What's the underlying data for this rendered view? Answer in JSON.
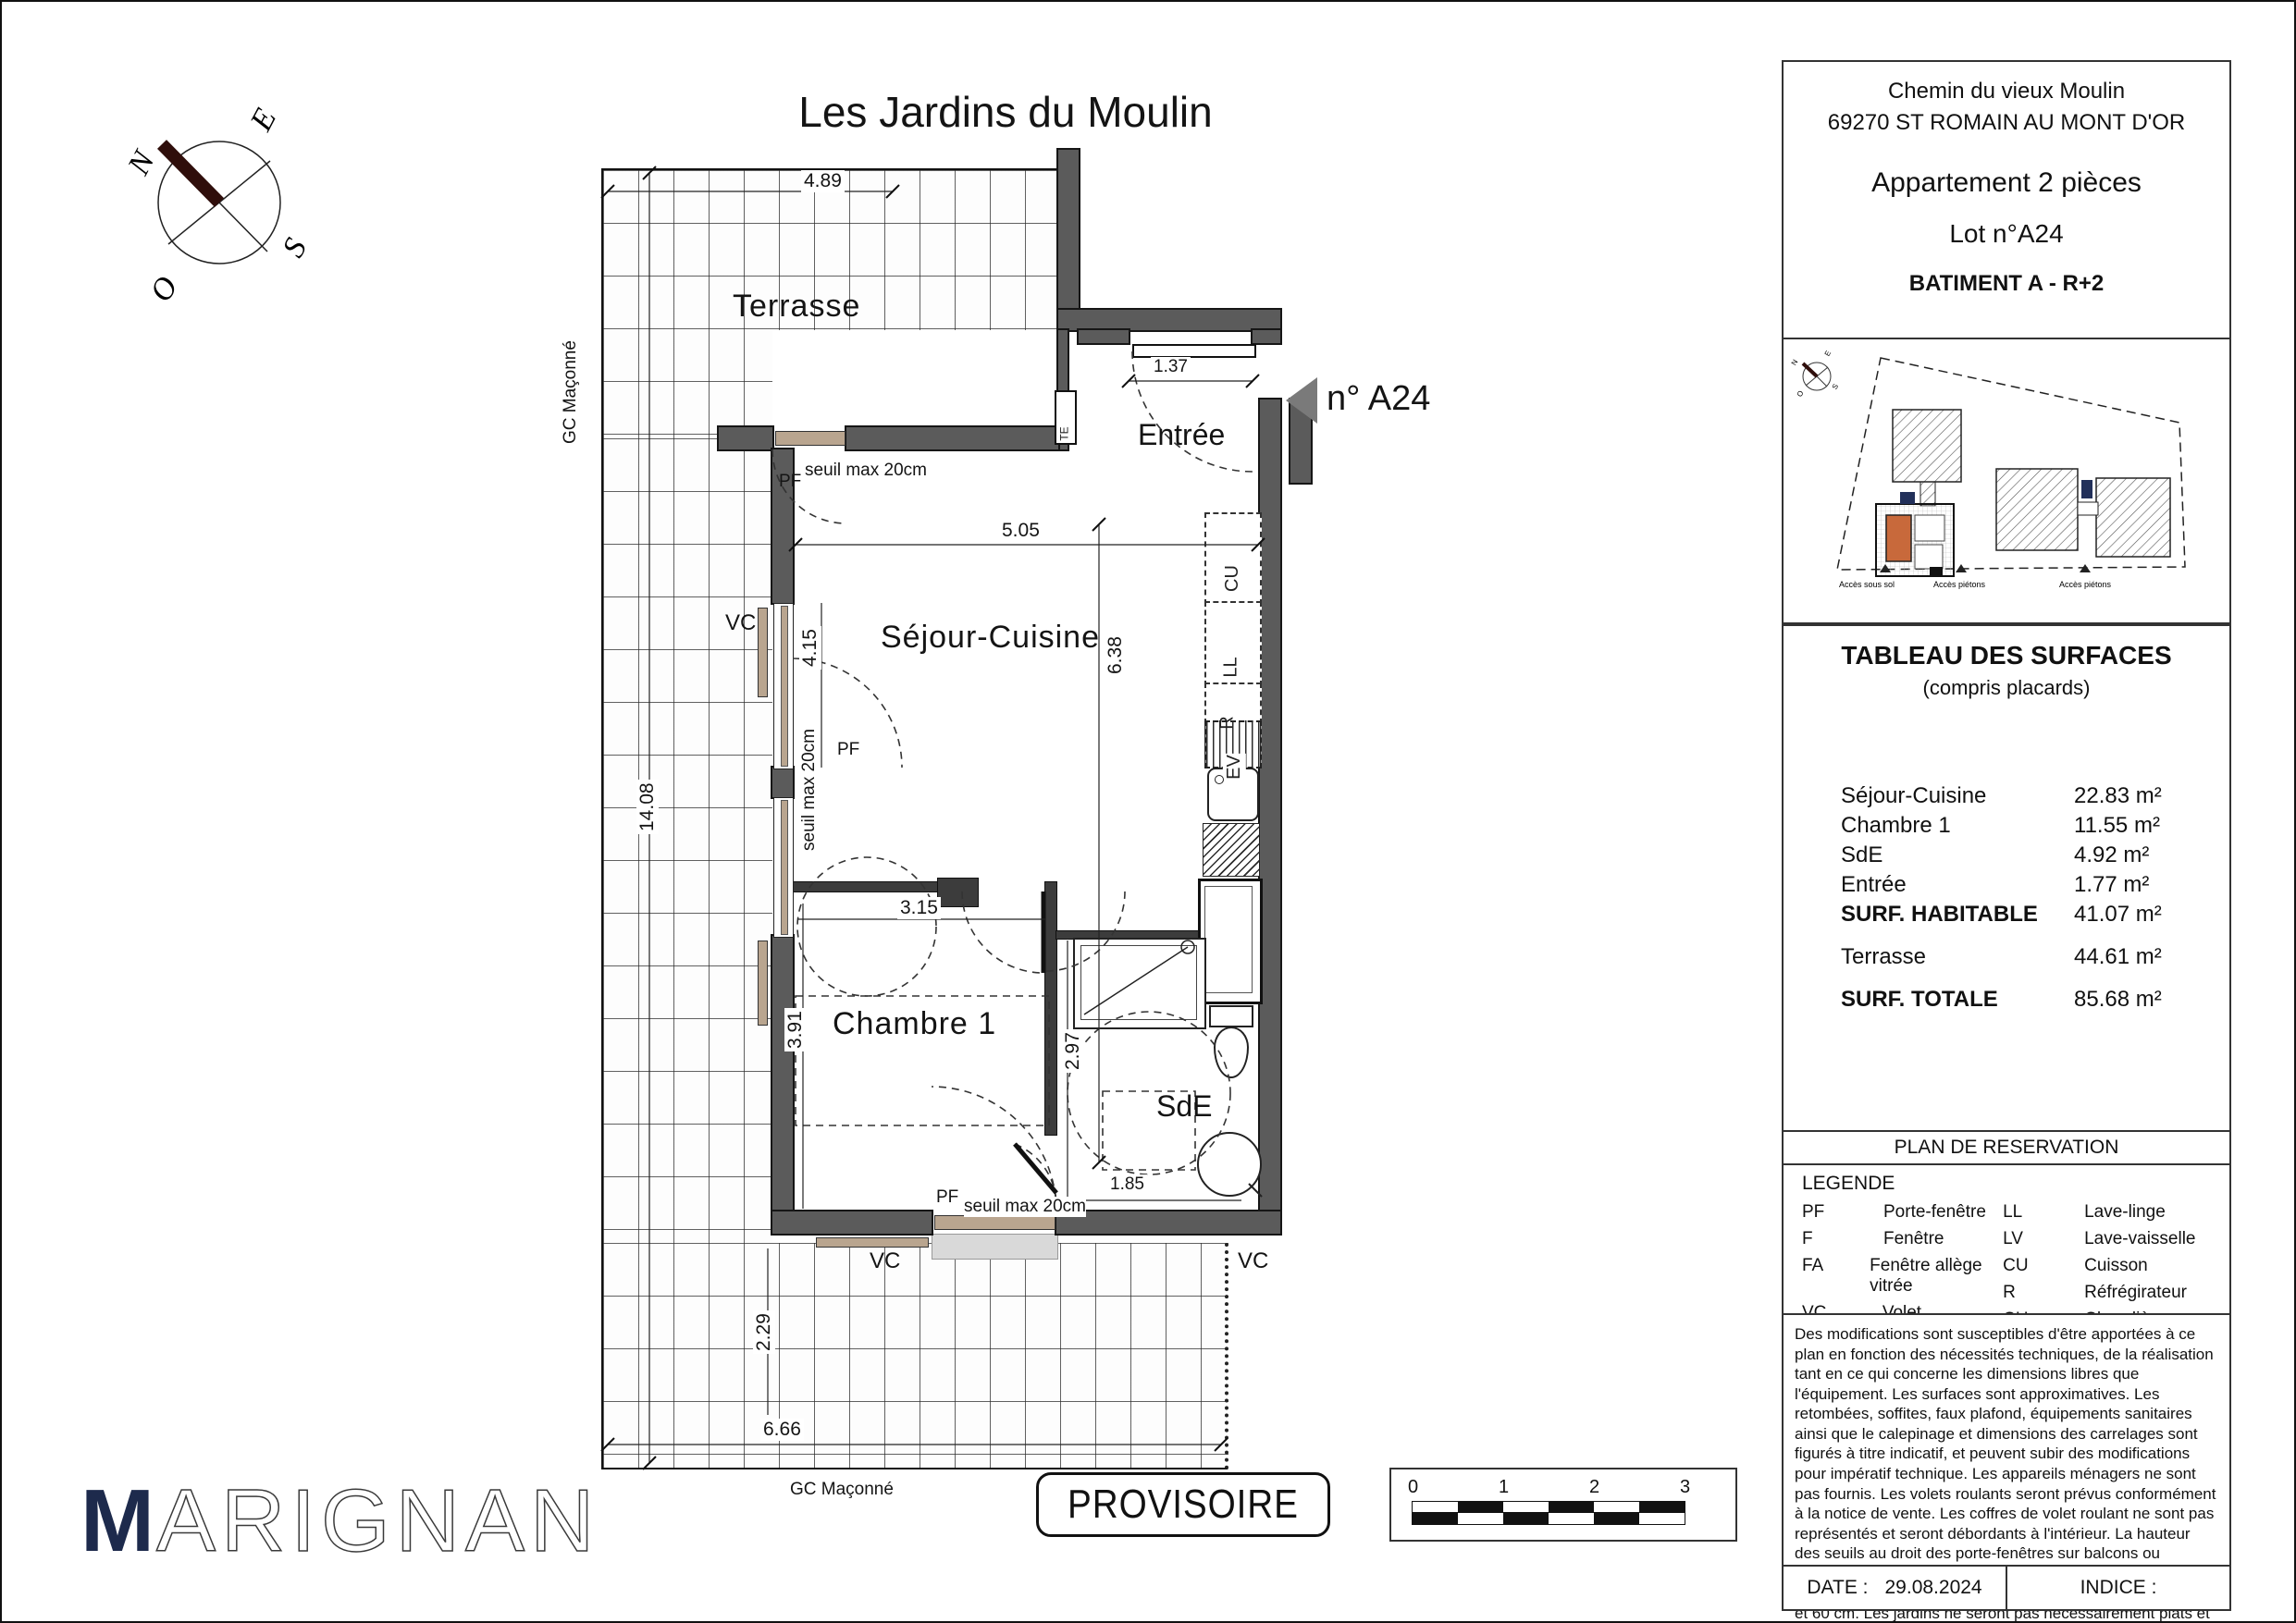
{
  "title": "Les Jardins du Moulin",
  "stamp": "PROVISOIRE",
  "logo": {
    "first": "M",
    "rest": "ARIGNAN"
  },
  "compass": {
    "n": "N",
    "e": "E",
    "s": "S",
    "o": "O"
  },
  "plan": {
    "rooms": {
      "terrasse": "Terrasse",
      "entree": "Entrée",
      "sejour": "Séjour-Cuisine",
      "chambre": "Chambre 1",
      "sde": "SdE"
    },
    "unit_arrow_label": "n° A24",
    "dims": {
      "terrace_top": "4.89",
      "terrace_left": "14.08",
      "entry_door": "1.37",
      "sejour_w": "5.05",
      "sejour_left": "4.15",
      "sejour_h": "6.38",
      "chambre_w": "3.15",
      "chambre_h": "3.91",
      "sde_h": "2.97",
      "sde_w": "1.85",
      "terrace_bot_h": "2.29",
      "terrace_bot_w": "6.66"
    },
    "annotations": {
      "seuil": "seuil max 20cm",
      "pf": "PF",
      "vc": "VC",
      "gc": "GC Maçonné",
      "te": "TE",
      "cu": "CU",
      "ll": "LL",
      "r": "R",
      "ev": "EV"
    }
  },
  "info_panel": {
    "address1": "Chemin du vieux Moulin",
    "address2": "69270 ST ROMAIN AU MONT D'OR",
    "type": "Appartement 2 pièces",
    "lot": "Lot n°A24",
    "building": "BATIMENT A -  R+2"
  },
  "site_plan": {
    "access1": "Accès sous sol",
    "access2": "Accès piétons",
    "access3": "Accès piétons"
  },
  "surfaces": {
    "title": "TABLEAU DES SURFACES",
    "subtitle": "(compris placards)",
    "rows": [
      {
        "label": "Séjour-Cuisine",
        "value": "22.83 m²"
      },
      {
        "label": "Chambre 1",
        "value": "11.55 m²"
      },
      {
        "label": "SdE",
        "value": "4.92 m²"
      },
      {
        "label": "Entrée",
        "value": "1.77 m²"
      },
      {
        "label": "SURF. HABITABLE",
        "value": "41.07 m²"
      },
      {
        "label": "Terrasse",
        "value": "44.61 m²"
      },
      {
        "label": "SURF. TOTALE",
        "value": "85.68 m²"
      }
    ]
  },
  "reservation_title": "PLAN DE RESERVATION",
  "legend": {
    "title": "LEGENDE",
    "col1": [
      {
        "abbr": "PF",
        "label": "Porte-fenêtre"
      },
      {
        "abbr": "F",
        "label": "Fenêtre"
      },
      {
        "abbr": "FA",
        "label": "Fenêtre allège vitrée"
      },
      {
        "abbr": "VC",
        "label": "Volet coulissant"
      },
      {
        "abbr": "GC",
        "label": "Garde corps"
      },
      {
        "abbr": "TE",
        "label": "Tableau électrique"
      }
    ],
    "col2": [
      {
        "abbr": "LL",
        "label": "Lave-linge"
      },
      {
        "abbr": "LV",
        "label": "Lave-vaisselle"
      },
      {
        "abbr": "CU",
        "label": "Cuisson"
      },
      {
        "abbr": "R",
        "label": "Réfrégirateur"
      },
      {
        "abbr": "CH",
        "label": "Chaudière"
      },
      {
        "abbr": "",
        "label": "Soffites et faux-plafond"
      }
    ]
  },
  "disclaimer": "Des modifications sont susceptibles d'être apportées à ce plan en fonction des nécessités techniques, de la réalisation tant en ce qui concerne les dimensions libres que l'équipement. Les surfaces sont approximatives. Les retombées, soffites, faux plafond, équipements sanitaires ainsi que le calepinage et dimensions des carrelages sont figurés à titre indicatif, et peuvent subir des modifications pour impératif technique. Les appareils ménagers ne sont pas fournis. Les volets roulants seront prévus conformément à la notice de vente. Les coffres de volet roulant ne sont pas représentés et seront débordants à l'intérieur. La hauteur des seuils au droit des porte-fenêtres sur balcons ou terrasses pourra varier de 5 à 35 cm à partir du sol intérieur. La hauteur entre le jardin et la terrasse pourra varier entre 0 et 60 cm. Les jardins ne seront pas nécessairement plats et pourront comporter des talus et des pentes.",
  "footer": {
    "date_label": "DATE :",
    "date": "29.08.2024",
    "indice_label": "INDICE :"
  },
  "scalebar": {
    "n0": "0",
    "n1": "1",
    "n2": "2",
    "n3": "3"
  },
  "colors": {
    "wall": "#5b5b5b",
    "navy": "#1d2a4c",
    "orange": "#c8693b",
    "needle": "#2f0e0b"
  }
}
